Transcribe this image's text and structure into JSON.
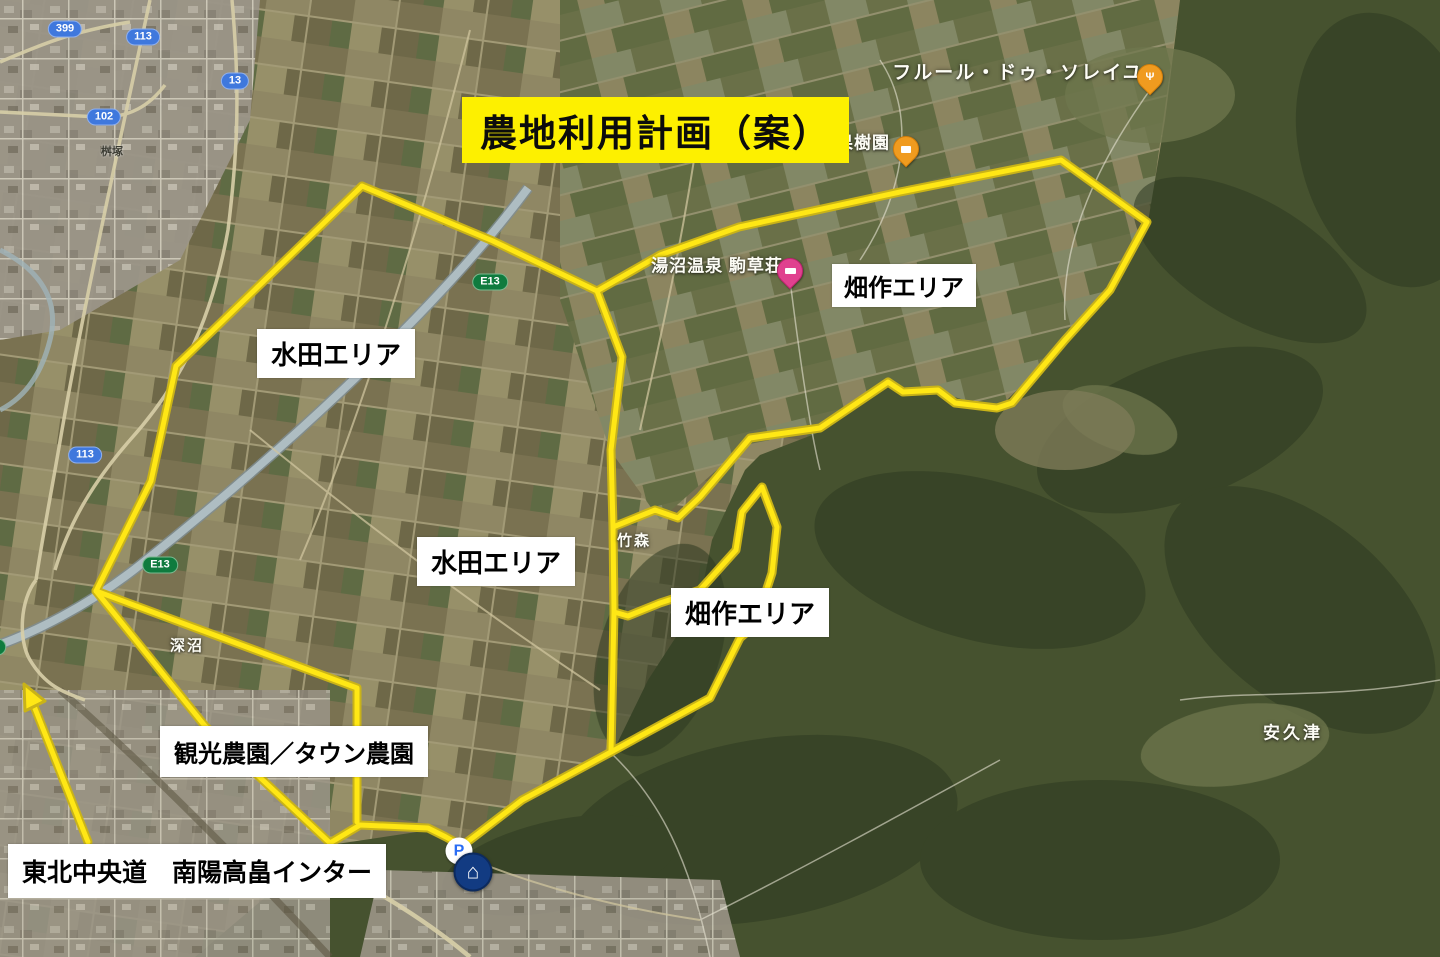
{
  "title": {
    "text": "農地利用計画（案）",
    "bg_color": "#fdf000",
    "fg_color": "#0c0c0c"
  },
  "area_labels": [
    {
      "id": "hatasaku-upper",
      "text": "畑作エリア"
    },
    {
      "id": "suiden-upper",
      "text": "水田エリア"
    },
    {
      "id": "suiden-lower",
      "text": "水田エリア"
    },
    {
      "id": "hatasaku-lower",
      "text": "畑作エリア"
    },
    {
      "id": "kanko",
      "text": "観光農園／タウン農園"
    },
    {
      "id": "expressway-note",
      "text": "東北中央道　南陽高畠インター"
    }
  ],
  "map_labels": [
    {
      "id": "fleur",
      "text": "フルール・ドゥ・ソレイユ"
    },
    {
      "id": "urushiyama",
      "text": "漆山果樹園"
    },
    {
      "id": "yunuma",
      "text": "湯沼温泉 駒草荘"
    },
    {
      "id": "takemori",
      "text": "竹森"
    },
    {
      "id": "fukanuma",
      "text": "深沼"
    },
    {
      "id": "akutsu",
      "text": "安久津"
    },
    {
      "id": "masuzuka",
      "text": "桝塚"
    }
  ],
  "road_shields": [
    {
      "text": "399",
      "type": "blue"
    },
    {
      "text": "113",
      "type": "blue"
    },
    {
      "text": "13",
      "type": "blue"
    },
    {
      "text": "102",
      "type": "blue"
    },
    {
      "text": "113",
      "type": "blue"
    },
    {
      "text": "E13",
      "type": "green"
    },
    {
      "text": "E13",
      "type": "green"
    },
    {
      "text": "E13",
      "type": "green"
    },
    {
      "text": "113",
      "type": "blue"
    }
  ],
  "pois": [
    {
      "name": "restaurant-pin",
      "label": "フルール・ドゥ・ソレイユ",
      "color": "#f09b1f"
    },
    {
      "name": "cafe-pin",
      "label": "漆山果樹園",
      "color": "#f09b1f"
    },
    {
      "name": "lodging-pin",
      "label": "湯沼温泉 駒草荘",
      "color": "#e0418f"
    },
    {
      "name": "parking-icon",
      "glyph": "P",
      "color": "#2a6df4"
    },
    {
      "name": "home-icon",
      "glyph": "⌂",
      "color": "#123b82"
    }
  ],
  "colors": {
    "plan_line": "#ffe715",
    "plan_line_edge": "#c9b318"
  }
}
